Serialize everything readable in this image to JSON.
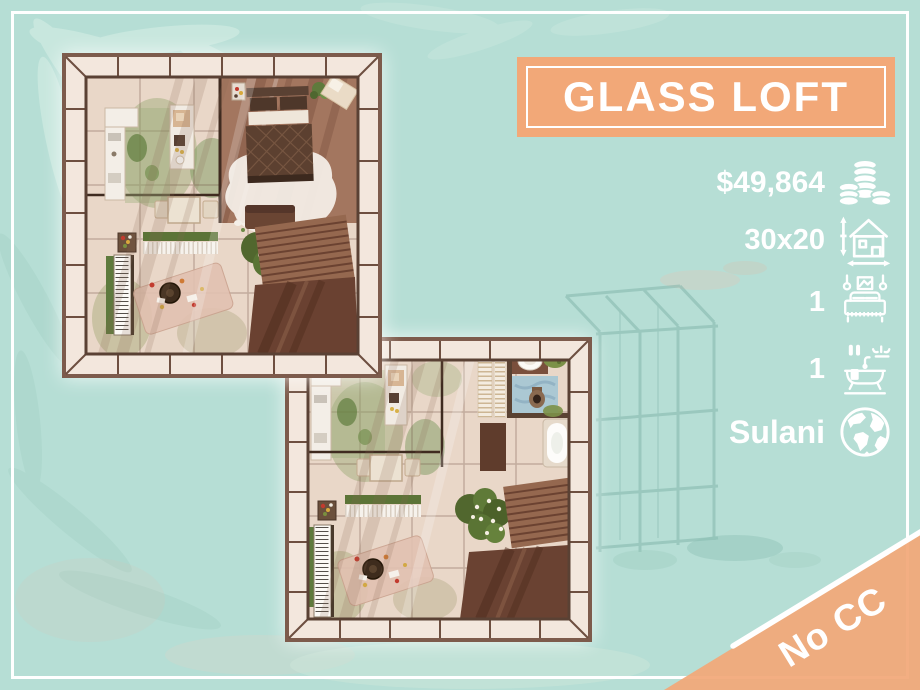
{
  "banner": {
    "title": "GLASS LOFT"
  },
  "stats": {
    "price": {
      "value": "$49,864",
      "icon": "coins-icon"
    },
    "lot_size": {
      "value": "30x20",
      "icon": "lot-dimensions-icon"
    },
    "bedrooms": {
      "value": "1",
      "icon": "bed-icon"
    },
    "bathrooms": {
      "value": "1",
      "icon": "bathtub-icon"
    },
    "world": {
      "value": "Sulani",
      "icon": "globe-icon"
    }
  },
  "ribbon": {
    "label": "No CC"
  },
  "colors": {
    "background": "#b6ded5",
    "accent": "#f2a878",
    "text": "#ffffff",
    "frame": "#ffffff"
  }
}
